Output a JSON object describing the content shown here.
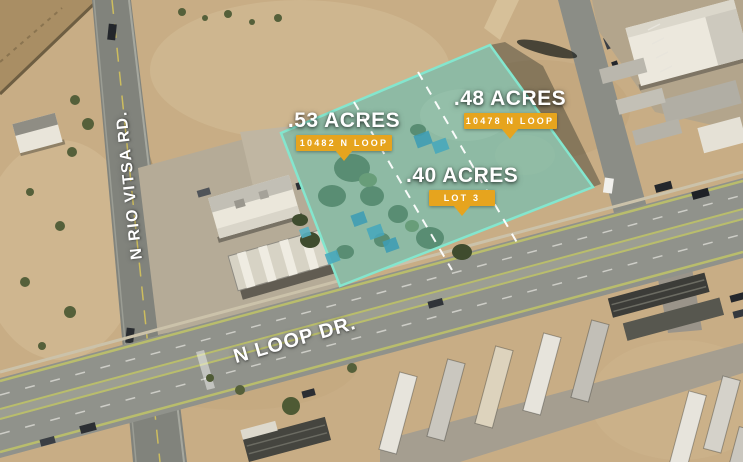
{
  "parcels": [
    {
      "acres": ".53 ACRES",
      "tag": "10482 N LOOP"
    },
    {
      "acres": ".48 ACRES",
      "tag": "10478 N LOOP"
    },
    {
      "acres": ".40 ACRES",
      "tag": "LOT 3"
    }
  ],
  "roads": {
    "vertical_label": "N RIO VITSA RD.",
    "diagonal_label": "N LOOP DR."
  },
  "colors": {
    "badge_gold": "#E6A41E",
    "parcel_fill": "#74CEB8",
    "parcel_border": "#84E6CE",
    "lot_line": "#FFFFFF",
    "label_text": "#FFFFFF"
  }
}
